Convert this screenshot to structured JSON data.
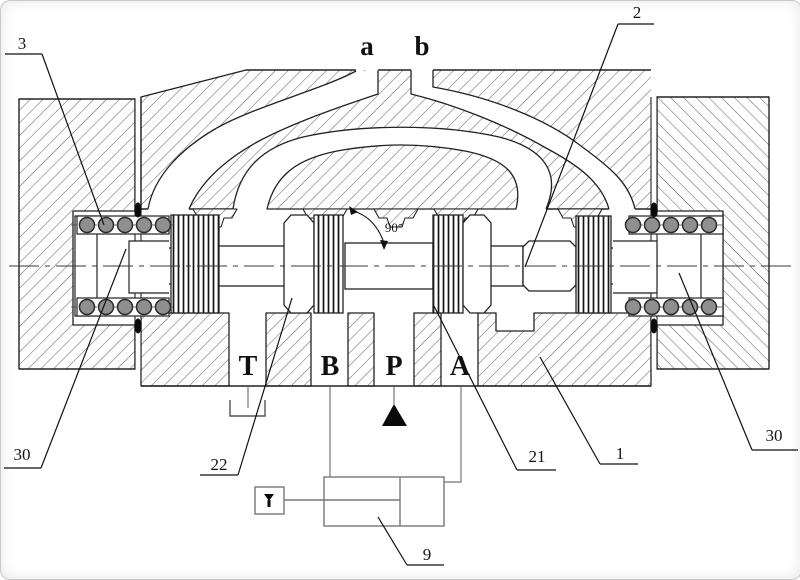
{
  "drawing": {
    "title_semantic": "hydraulic directional valve cross-section",
    "background": "#ffffff",
    "ink": "#1f1f1f",
    "hatch_color": "#5c5c5c",
    "circuit_color": "#8a8a8a",
    "spring_fill": "#8f8f8f",
    "pilot_ports": [
      {
        "label": "a",
        "x": 366,
        "y": 54
      },
      {
        "label": "b",
        "x": 421,
        "y": 54
      }
    ],
    "main_ports": [
      {
        "label": "T",
        "x": 247,
        "y": 374
      },
      {
        "label": "B",
        "x": 329,
        "y": 374
      },
      {
        "label": "P",
        "x": 393,
        "y": 374
      },
      {
        "label": "A",
        "x": 459,
        "y": 374
      }
    ],
    "angle_annotation": {
      "text": "90°",
      "x": 393,
      "y": 231
    },
    "callouts": [
      {
        "ref": "3",
        "x": 21,
        "y": 48,
        "underline": [
          4,
          53,
          41,
          53
        ],
        "leader": [
          41,
          53,
          103,
          224
        ]
      },
      {
        "ref": "2",
        "x": 636,
        "y": 17,
        "underline": [
          617,
          23,
          653,
          23
        ],
        "leader": [
          617,
          23,
          524,
          266
        ]
      },
      {
        "ref": "30",
        "x": 21,
        "y": 459,
        "underline": [
          3,
          467,
          40,
          467
        ],
        "leader": [
          40,
          467,
          125,
          248
        ]
      },
      {
        "ref": "22",
        "x": 218,
        "y": 469,
        "underline": [
          199,
          474,
          237,
          474
        ],
        "leader": [
          237,
          474,
          291,
          297
        ]
      },
      {
        "ref": "21",
        "x": 536,
        "y": 461,
        "underline": [
          516,
          469,
          555,
          469
        ],
        "leader": [
          516,
          469,
          433,
          305
        ]
      },
      {
        "ref": "1",
        "x": 619,
        "y": 458,
        "underline": [
          599,
          463,
          637,
          463
        ],
        "leader": [
          599,
          463,
          539,
          356
        ]
      },
      {
        "ref": "30",
        "x": 773,
        "y": 440,
        "underline": [
          751,
          449,
          797,
          449
        ],
        "leader": [
          751,
          449,
          678,
          272
        ]
      },
      {
        "ref": "9",
        "x": 426,
        "y": 559,
        "underline": [
          406,
          564,
          443,
          564
        ],
        "leader": [
          406,
          564,
          377,
          516
        ]
      }
    ]
  }
}
